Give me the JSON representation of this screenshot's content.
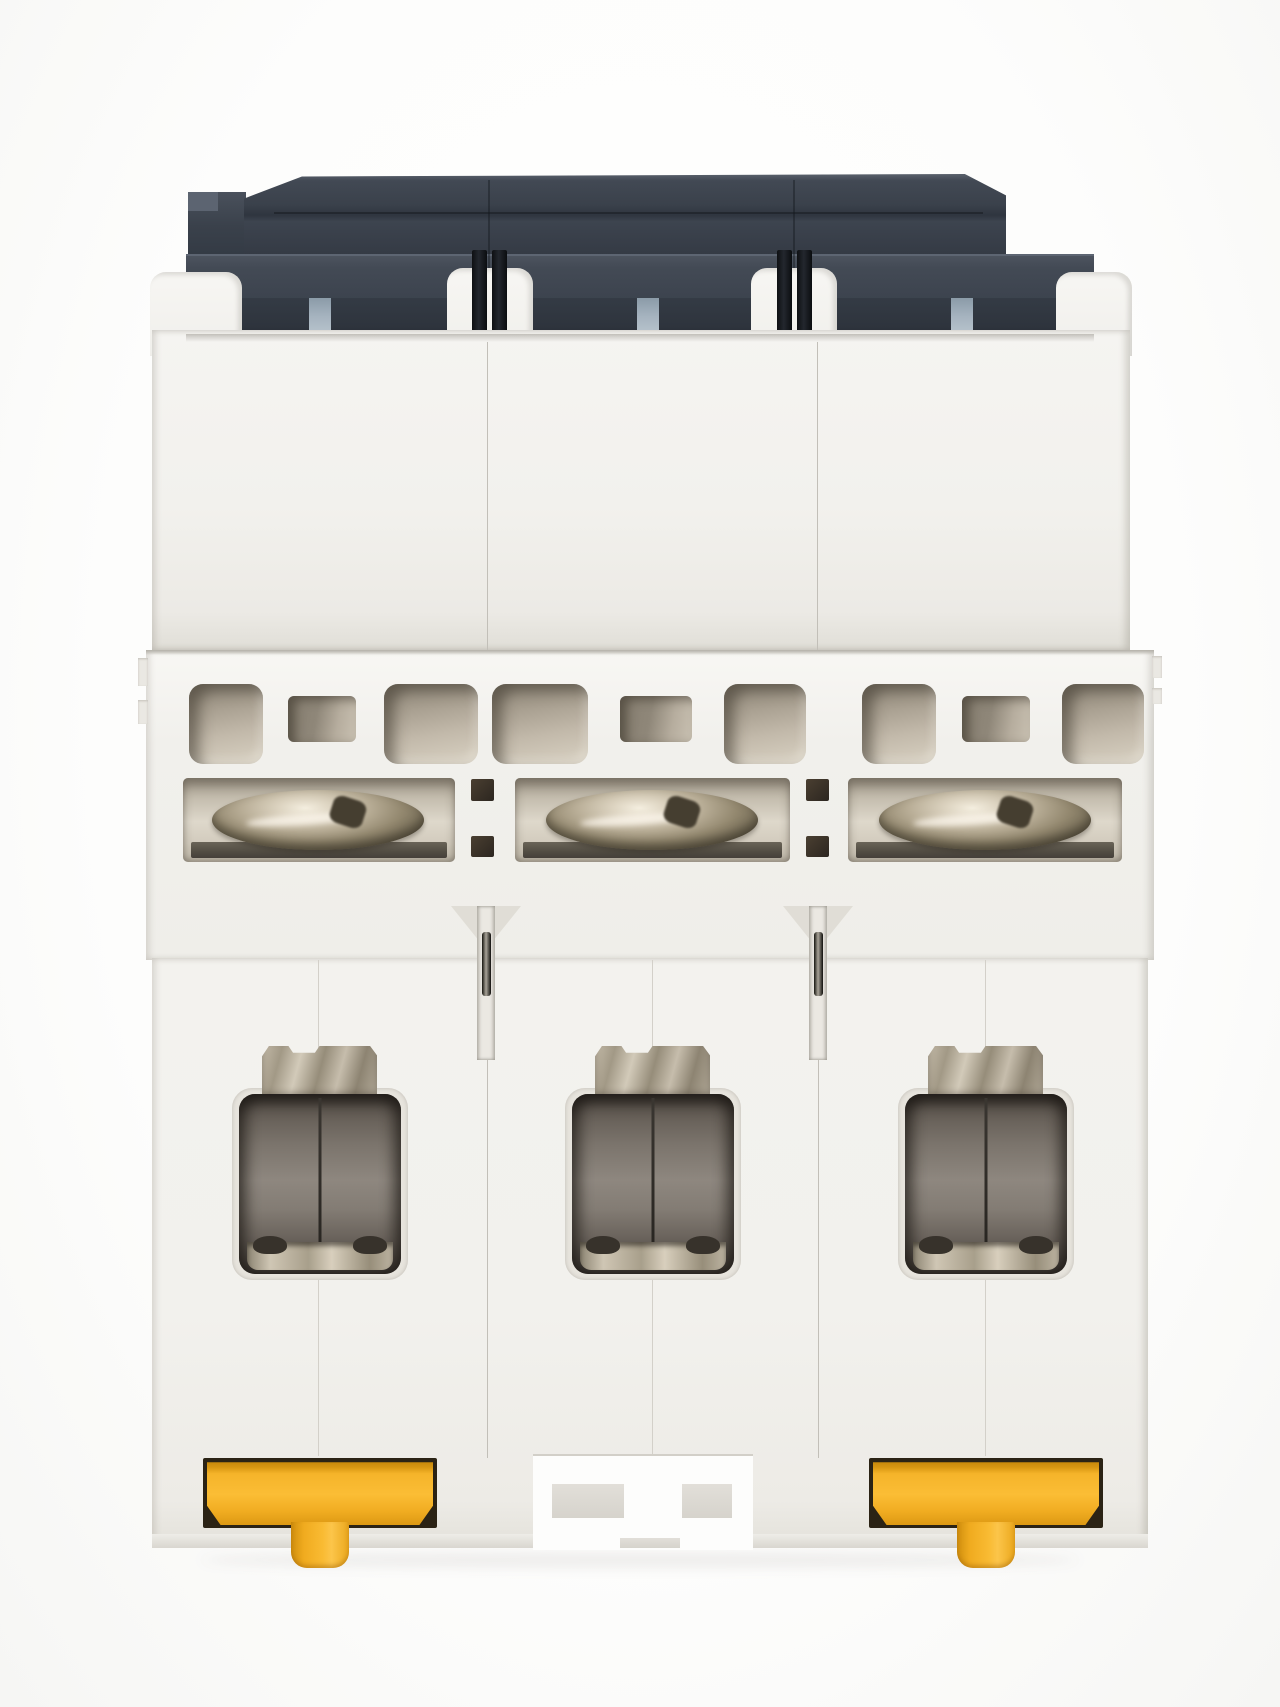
{
  "image_type": "product-photograph",
  "scene": {
    "description": "Studio photo of a 3-pole DIN-rail miniature circuit breaker viewed from the bottom terminal side on a white background",
    "module_count": 3,
    "visible_text": ""
  },
  "parts": {
    "top_cover": "charcoal moulded top cover",
    "module_shoulder": "white housing shoulder lobe",
    "pole_link_pins": "black inter-pole linkage pins",
    "busbar_tab": "blue-grey busbar slot tab",
    "housing_upper": "upper white housing face",
    "housing_mid": "mid housing step with arc vents",
    "housing_lower": "lower white housing face",
    "arc_vent": "arc-chute vent window",
    "vent_window": "small vent window",
    "screw_recess": "terminal screw recess",
    "terminal_screw": "slotted terminal screw head",
    "seam_hole": "inter-module vent hole",
    "pole_channel": "inter-pole pin channel",
    "clamp_plate": "terminal clamp plate",
    "terminal_opening": "wire terminal opening",
    "din_clip": "yellow DIN-rail release clip",
    "din_clip_tab": "yellow clip pull tab",
    "din_notch": "DIN-rail mounting notch",
    "ground_shadow": "soft drop shadow"
  },
  "colors": {
    "charcoal": "#3d444f",
    "charcoal_dark": "#2e343d",
    "pin_black": "#14171b",
    "busbar_blue": "#a5b3bf",
    "housing_white": "#f2f1ed",
    "housing_shadow": "#dcd9d2",
    "vent_taupe": "#b6ad9f",
    "recess_tan": "#cfc8ba",
    "screw_silver": "#c8bfab",
    "terminal_gray": "#837c74",
    "metal_light": "#cfc6b4",
    "clip_yellow": "#f9bb33",
    "clip_orange": "#d89712",
    "background": "#fdfdfc"
  }
}
